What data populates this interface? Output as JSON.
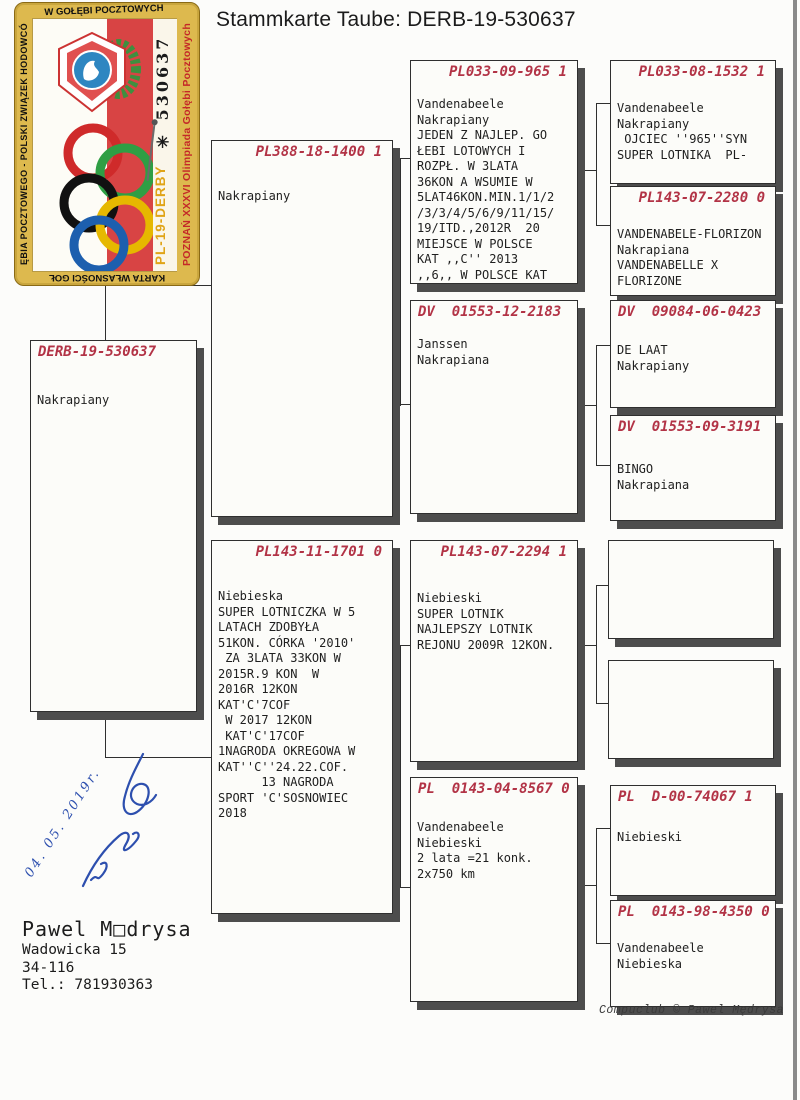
{
  "title": "Stammkarte Taube: DERB-19-530637",
  "colors": {
    "header_red": "#b23346",
    "signature_blue": "#2d4fae",
    "stamp_gold": "#ddb94e",
    "flag_red": "#d84444",
    "ring_red": "#cf2a2a",
    "ring_green": "#2f9e44",
    "ring_black": "#111111",
    "ring_yellow": "#e6b800",
    "ring_blue": "#1d5fae"
  },
  "stamp": {
    "border_top": "W GOŁĘBI POCZTOWYCH",
    "border_left": "ĘBIA POCZTOWEGO - POLSKI ZWIĄZEK HODOWCÓ",
    "border_bottom": "KARTA WŁASNOŚCI GOŁ",
    "olympiad_band": "POZNAŃ XXXVI Olimpiada Gołębi Pocztowych",
    "ring_number_vertical": "✳ 530637",
    "derby": "PL-19-DERBY"
  },
  "pedigree": {
    "subject": {
      "id": "DERB-19-530637",
      "notes": "Nakrapiany"
    },
    "father": {
      "id": "PL388-18-1400 1",
      "notes": "Nakrapiany"
    },
    "mother": {
      "id": "PL143-11-1701 0",
      "notes": "Niebieska\nSUPER LOTNICZKA W 5\nLATACH ZDOBYŁA\n51KON. CÓRKA '2010'\n ZA 3LATA 33KON W\n2015R.9 KON  W\n2016R 12KON\nKAT'C'7COF\n W 2017 12KON\n KAT'C'17COF\n1NAGRODA OKREGOWA W\nKAT''C''24.22.COF.\n      13 NAGRODA\nSPORT 'C'SOSNOWIEC\n2018"
    },
    "ff": {
      "id": "PL033-09-965 1",
      "notes": "Vandenabeele\nNakrapiany\nJEDEN Z NAJLEP. GO\nŁEBI LOTOWYCH I\nROZPŁ. W 3LATA\n36KON A WSUMIE W\n5LAT46KON.MIN.1/1/2\n/3/3/4/5/6/9/11/15/\n19/ITD.,2012R  20\nMIEJSCE W POLSCE\nKAT ,,C'' 2013\n,,6,, W POLSCE KAT"
    },
    "fm": {
      "id": "DV  01553-12-2183",
      "notes": "Janssen\nNakrapiana"
    },
    "mf": {
      "id": "PL143-07-2294 1",
      "notes": "Niebieski\nSUPER LOTNIK\nNAJLEPSZY LOTNIK\nREJONU 2009R 12KON."
    },
    "mm": {
      "id": "PL  0143-04-8567 0",
      "notes": "Vandenabeele\nNiebieski\n2 lata =21 konk.\n2x750 km"
    },
    "fff": {
      "id": "PL033-08-1532 1",
      "notes": "Vandenabeele\nNakrapiany\n OJCIEC ''965''SYN\nSUPER LOTNIKA  PL-"
    },
    "ffm": {
      "id": "PL143-07-2280 0",
      "notes": "VANDENABELE-FLORIZON\nNakrapiana\nVANDENABELLE X\nFLORIZONE"
    },
    "fmf": {
      "id": "DV  09084-06-0423",
      "notes": "DE LAAT\nNakrapiany"
    },
    "fmm": {
      "id": "DV  01553-09-3191",
      "notes": "BINGO\nNakrapiana"
    },
    "mff": {
      "id": "",
      "notes": ""
    },
    "mfm": {
      "id": "",
      "notes": ""
    },
    "mmf": {
      "id": "PL  D-00-74067 1",
      "notes": "Niebieski"
    },
    "mmm": {
      "id": "PL  0143-98-4350 0",
      "notes": "Vandenabeele\nNiebieska"
    }
  },
  "owner": {
    "name": "Pawel M□drysa",
    "street": "Wadowicka 15",
    "postal": "34-116",
    "phone": "Tel.: 781930363"
  },
  "signature": {
    "date": "04. 05. 2019r."
  },
  "footer": "Compuclub © Pawel Mędrysa"
}
